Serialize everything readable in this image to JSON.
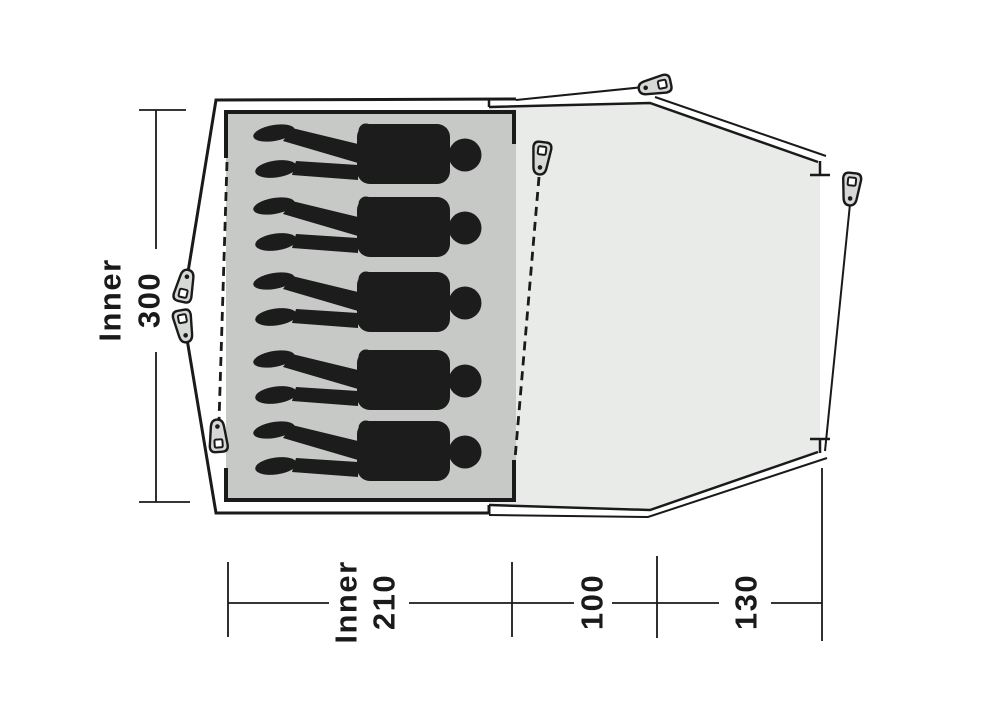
{
  "diagram": {
    "subject": "tent-floor-plan-top-view",
    "occupant_count": 5,
    "peg_count": 6
  },
  "labels": {
    "inner_depth": {
      "prefix": "Inner",
      "value": "300"
    },
    "inner_width": {
      "prefix": "Inner",
      "value": "210"
    },
    "mid_width": {
      "value": "100"
    },
    "front_width": {
      "value": "130"
    }
  },
  "colors": {
    "background": "#ffffff",
    "line": "#1a1a1a",
    "inner_area": "#c7c9c7",
    "porch_area": "#e9ebe9",
    "peg_fill": "#d6d8d6",
    "silhouette": "#1c1c1c"
  }
}
